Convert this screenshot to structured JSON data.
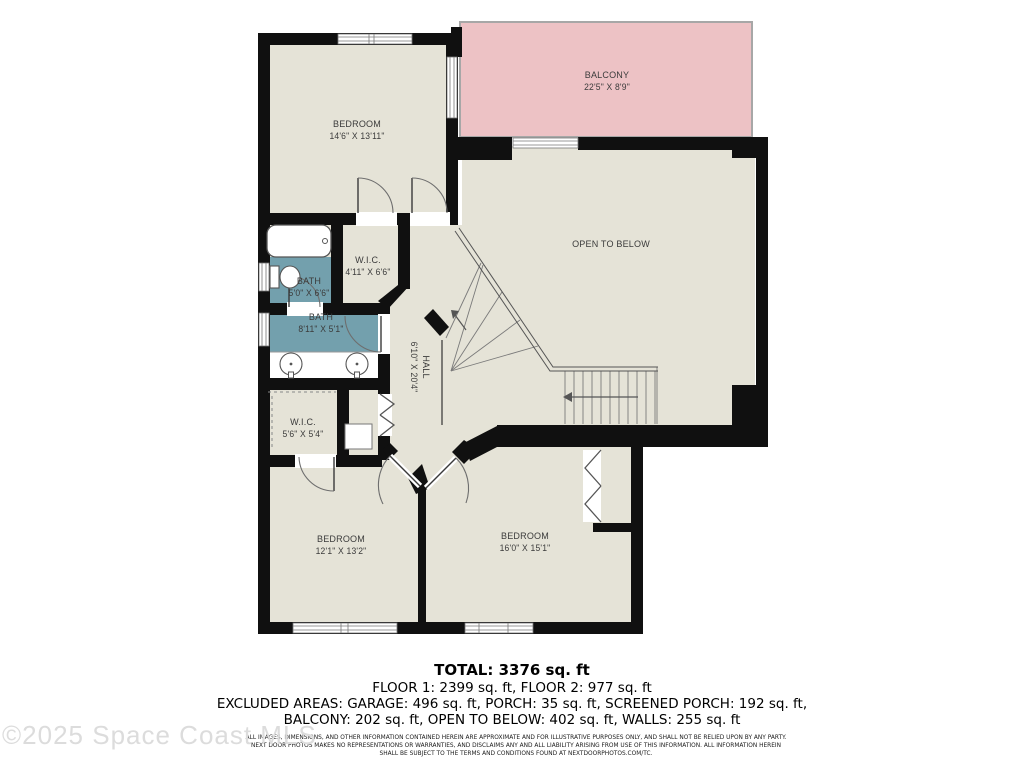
{
  "floor_plan": {
    "rooms": {
      "bedroom_top": {
        "name": "BEDROOM",
        "dims": "14'6\" X 13'11\""
      },
      "balcony": {
        "name": "BALCONY",
        "dims": "22'5\" X 8'9\""
      },
      "open_to_below": {
        "name": "OPEN TO BELOW",
        "dims": ""
      },
      "wic_top": {
        "name": "W.I.C.",
        "dims": "4'11\" X 6'6\""
      },
      "bath_small": {
        "name": "BATH",
        "dims": "5'0\" X 6'6\""
      },
      "bath_large": {
        "name": "BATH",
        "dims": "8'11\" X 5'1\""
      },
      "hall": {
        "name": "HALL",
        "dims": "6'10\" X 20'4\""
      },
      "wic_bottom": {
        "name": "W.I.C.",
        "dims": "5'6\" X 5'4\""
      },
      "bedroom_left": {
        "name": "BEDROOM",
        "dims": "12'1\" X 13'2\""
      },
      "bedroom_right": {
        "name": "BEDROOM",
        "dims": "16'0\" X 15'1\""
      }
    },
    "colors": {
      "room_fill": "#e5e3d7",
      "balcony_fill": "#edc2c5",
      "bath_fill": "#73a0ad",
      "wall": "#101010"
    }
  },
  "summary": {
    "total": "TOTAL: 3376 sq. ft",
    "floors": "FLOOR 1: 2399 sq. ft, FLOOR 2: 977 sq. ft",
    "excluded_1": "EXCLUDED AREAS: GARAGE: 496 sq. ft, PORCH: 35 sq. ft, SCREENED PORCH: 192 sq. ft,",
    "excluded_2": "BALCONY: 202 sq. ft, OPEN TO BELOW: 402 sq. ft, WALLS: 255 sq. ft"
  },
  "disclaimer": {
    "line1": "ALL IMAGES, DIMENSIONS, AND OTHER INFORMATION CONTAINED HEREIN ARE APPROXIMATE AND FOR ILLUSTRATIVE PURPOSES ONLY, AND SHALL NOT BE RELIED UPON BY ANY PARTY.",
    "line2": "NEXT DOOR PHOTOS MAKES NO REPRESENTATIONS OR WARRANTIES, AND DISCLAIMS ANY AND ALL LIABILITY ARISING FROM USE OF THIS INFORMATION. ALL INFORMATION HEREIN",
    "line3": "SHALL BE SUBJECT TO THE TERMS AND CONDITIONS FOUND AT NEXTDOORPHOTOS.COM/TC."
  },
  "watermark": "©2025 Space Coast MLS"
}
